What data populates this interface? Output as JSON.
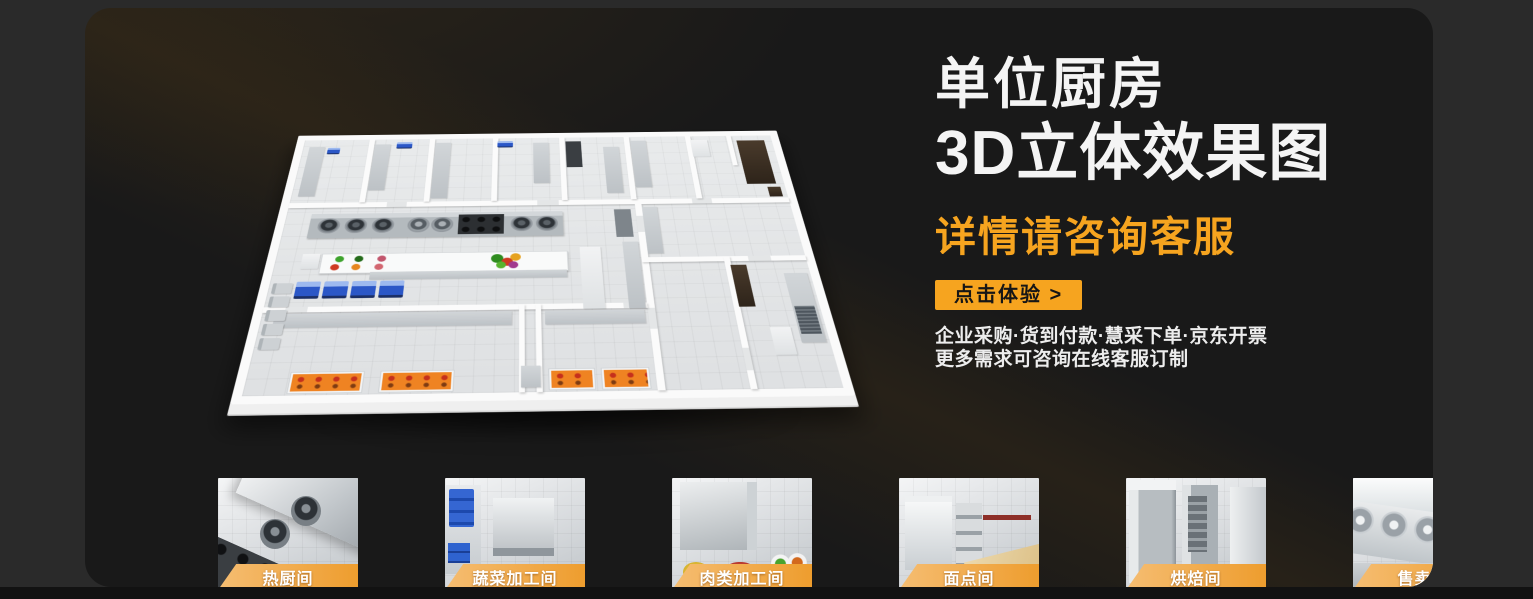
{
  "hero": {
    "title_line1": "单位厨房",
    "title_line2": "3D立体效果图",
    "subtitle": "详情请咨询客服",
    "cta_label": "点击体验 >",
    "note_line1": "企业采购·货到付款·慧采下单·京东开票",
    "note_line2": "更多需求可咨询在线客服订制"
  },
  "colors": {
    "accent_orange": "#f6a41f",
    "label_gradient_start": "#f5bd72",
    "label_gradient_end": "#ee9d2e",
    "panel_bg": "#191919",
    "page_bg": "#2a2a2a"
  },
  "thumbnails": [
    {
      "label": "热厨间"
    },
    {
      "label": "蔬菜加工间"
    },
    {
      "label": "肉类加工间"
    },
    {
      "label": "面点间"
    },
    {
      "label": "烘焙间"
    },
    {
      "label": "售卖间"
    },
    {
      "label": "凉菜间"
    },
    {
      "label": "消洗间"
    }
  ]
}
